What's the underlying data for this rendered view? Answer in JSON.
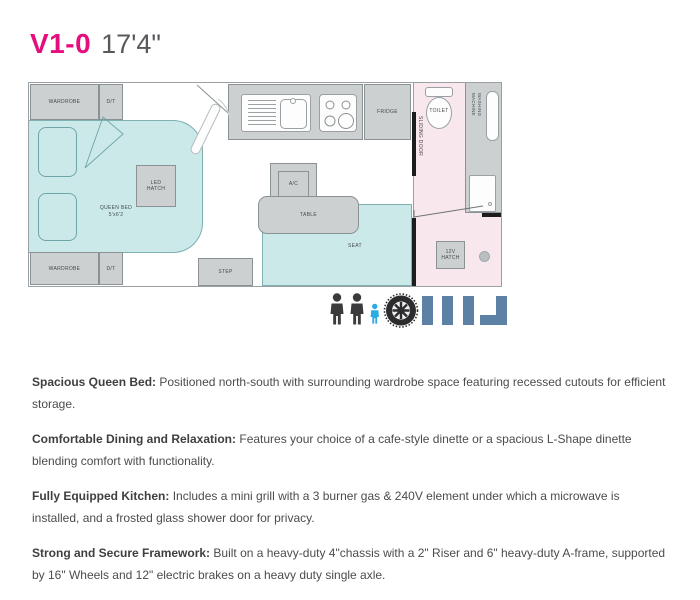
{
  "header": {
    "model": "V1-0",
    "length": "17'4\""
  },
  "floorplan": {
    "labels": {
      "wardrobe_top": "WARDROBE",
      "dt_top": "D/T",
      "wardrobe_bottom": "WARDROBE",
      "dt_bottom": "D/T",
      "led_hatch_line1": "LED",
      "led_hatch_line2": "HATCH",
      "queen_bed": "QUEEN BED",
      "queen_bed_size": "5'x6'2",
      "table": "TABLE",
      "seat": "SEAT",
      "step": "STEP",
      "ac": "A/C",
      "fridge": "FRIDGE",
      "sliding_door": "SLIDING DOOR",
      "toilet": "TOILET",
      "washing_machine_line1": "WASHING",
      "washing_machine_line2": "MACHINE",
      "hatch_12v_line1": "12V",
      "hatch_12v_line2": "HATCH"
    },
    "colors": {
      "bed_teal": "#cbe9e8",
      "teal_border": "#7fb0b2",
      "cabinet_gray": "#ccd0d1",
      "gray_border": "#8b9295",
      "bathroom_pink": "#f9e7ee",
      "wall_black": "#1d1d1f",
      "outline": "#9aa0a3"
    }
  },
  "capacity_icons": [
    "adult-icon",
    "adult-icon",
    "child-icon",
    "wheel-icon",
    "cafe-dinette-icon",
    "l-shape-dinette-icon"
  ],
  "icon_colors": {
    "adult": "#3b3b3d",
    "child": "#2aabe2",
    "wheel": "#2c2c2e",
    "dinette": "#5d81a5"
  },
  "title_colors": {
    "model": "#e60d7e",
    "length": "#58595c"
  },
  "features": [
    {
      "title": "Spacious Queen Bed:",
      "text": "Positioned north-south with surrounding wardrobe space featuring recessed cutouts for efficient storage."
    },
    {
      "title": "Comfortable Dining and Relaxation:",
      "text": "Features your choice of a cafe-style dinette or  a spacious L-Shape dinette blending comfort with functionality."
    },
    {
      "title": "Fully Equipped Kitchen:",
      "text": "Includes a mini grill with a 3 burner gas & 240V element under which a microwave is installed, and a frosted glass shower door for privacy."
    },
    {
      "title": "Strong and Secure Framework:",
      "text": "Built on a heavy-duty 4\"chassis with a 2\" Riser and 6\" heavy-duty A-frame, supported by 16\" Wheels and 12\" electric brakes on a heavy duty single axle."
    }
  ]
}
